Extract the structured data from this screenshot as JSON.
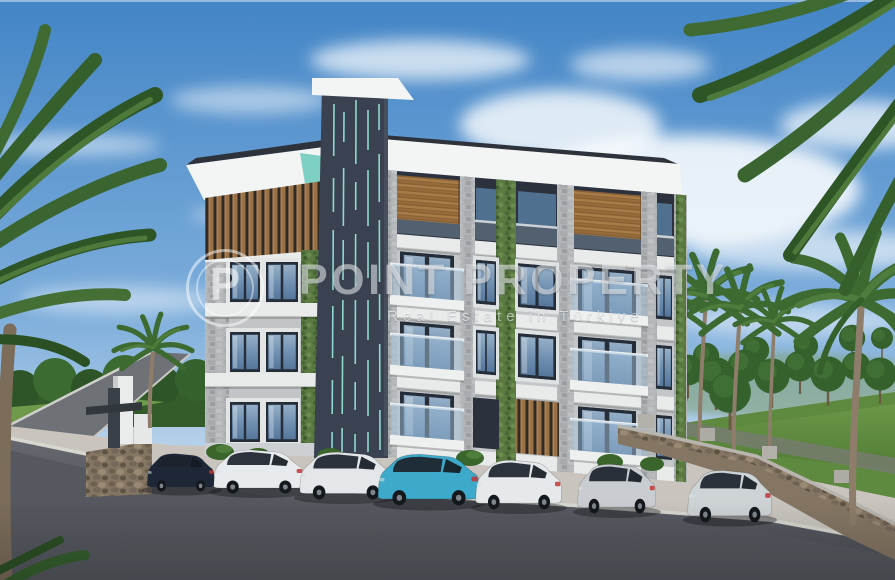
{
  "watermark": {
    "logo_letter": "P",
    "brand": "POINT PROPERTY",
    "tagline": "Real Estate in Türkiye"
  },
  "scene": {
    "description": "3D exterior rendering of a modern 4-storey apartment building with a dark elevator tower with mint stripes, wood-slat and stone facade, vertical gardens, palm trees, stone retaining walls and seven cars parked along a new asphalt road under a blue sky with wispy clouds",
    "sky": {
      "top": "#4385c6",
      "mid": "#7fafdc",
      "horizon": "#c3d9ed"
    },
    "building": {
      "tower": "#3a4150",
      "tower_stripes": "#8fd9cf",
      "roof": "#f3f5f4",
      "stone": "#b2b5b8",
      "wood": "#9a7145",
      "dark_wall": "#2b323e",
      "garden": "#5a7a42",
      "glass": "#7fa3c8",
      "mint_accent": "#7fd0c4",
      "floors": 4
    },
    "ground": {
      "asphalt": "#55585e",
      "pavement": "#c9c5be",
      "grass": "#5d8a3e",
      "wall_stone": "#857663"
    },
    "cars": [
      {
        "label": "dark navy SUV",
        "color": "#1d2737"
      },
      {
        "label": "white crossover",
        "color": "#e8ebed"
      },
      {
        "label": "white SUV",
        "color": "#e3e7ea"
      },
      {
        "label": "teal fastback",
        "color": "#3da9cb"
      },
      {
        "label": "white SUV",
        "color": "#e6e9eb"
      },
      {
        "label": "silver SUV",
        "color": "#c9cdd1"
      },
      {
        "label": "silver wagon",
        "color": "#ced3d6"
      }
    ]
  }
}
